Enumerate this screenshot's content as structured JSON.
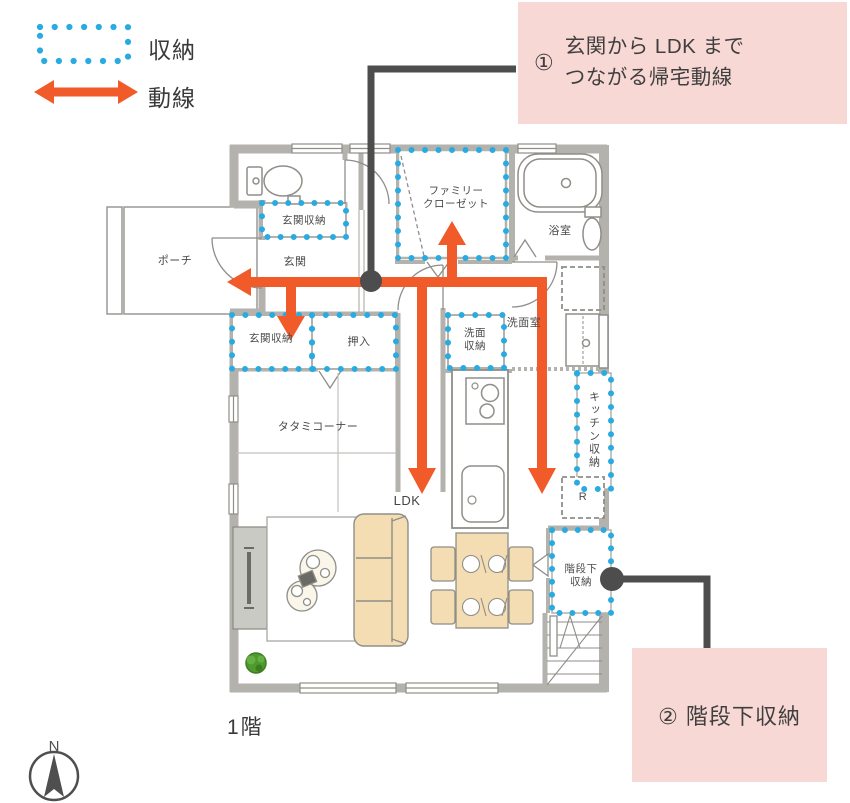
{
  "legend": {
    "items": [
      {
        "icon": "storage-dotted-outline-icon",
        "label": "収納"
      },
      {
        "icon": "flow-arrow-icon",
        "label": "動線"
      }
    ]
  },
  "callouts": {
    "callout1": {
      "number": "①",
      "text": "玄関から LDK まで\nつながる帰宅動線"
    },
    "callout2": {
      "text": "② 階段下収納"
    }
  },
  "rooms": {
    "porch": "ポーチ",
    "genkan": "玄関",
    "genkan_storage_top": "玄関収納",
    "family_closet": "ファミリー\nクローゼット",
    "bathroom": "浴室",
    "washroom": "洗面室",
    "washroom_storage": "洗面\n収納",
    "oshiire": "押入",
    "genkan_storage_bottom": "玄関収納",
    "tatami_corner": "タタミコーナー",
    "ldk": "LDK",
    "kitchen_storage": "キッチン収納",
    "fridge": "R",
    "stairs_storage": "階段下\n収納"
  },
  "floor_label": "1階",
  "compass": {
    "north_label": "N"
  },
  "colors": {
    "storage_dot_blue": "#29abe2",
    "flow_arrow_orange": "#f15a29",
    "callout_pink": "#f8d8d4",
    "connector_gray": "#4d4d4d",
    "wall_gray": "#b3b2ac",
    "furniture_tan": "#f5ddb3"
  }
}
